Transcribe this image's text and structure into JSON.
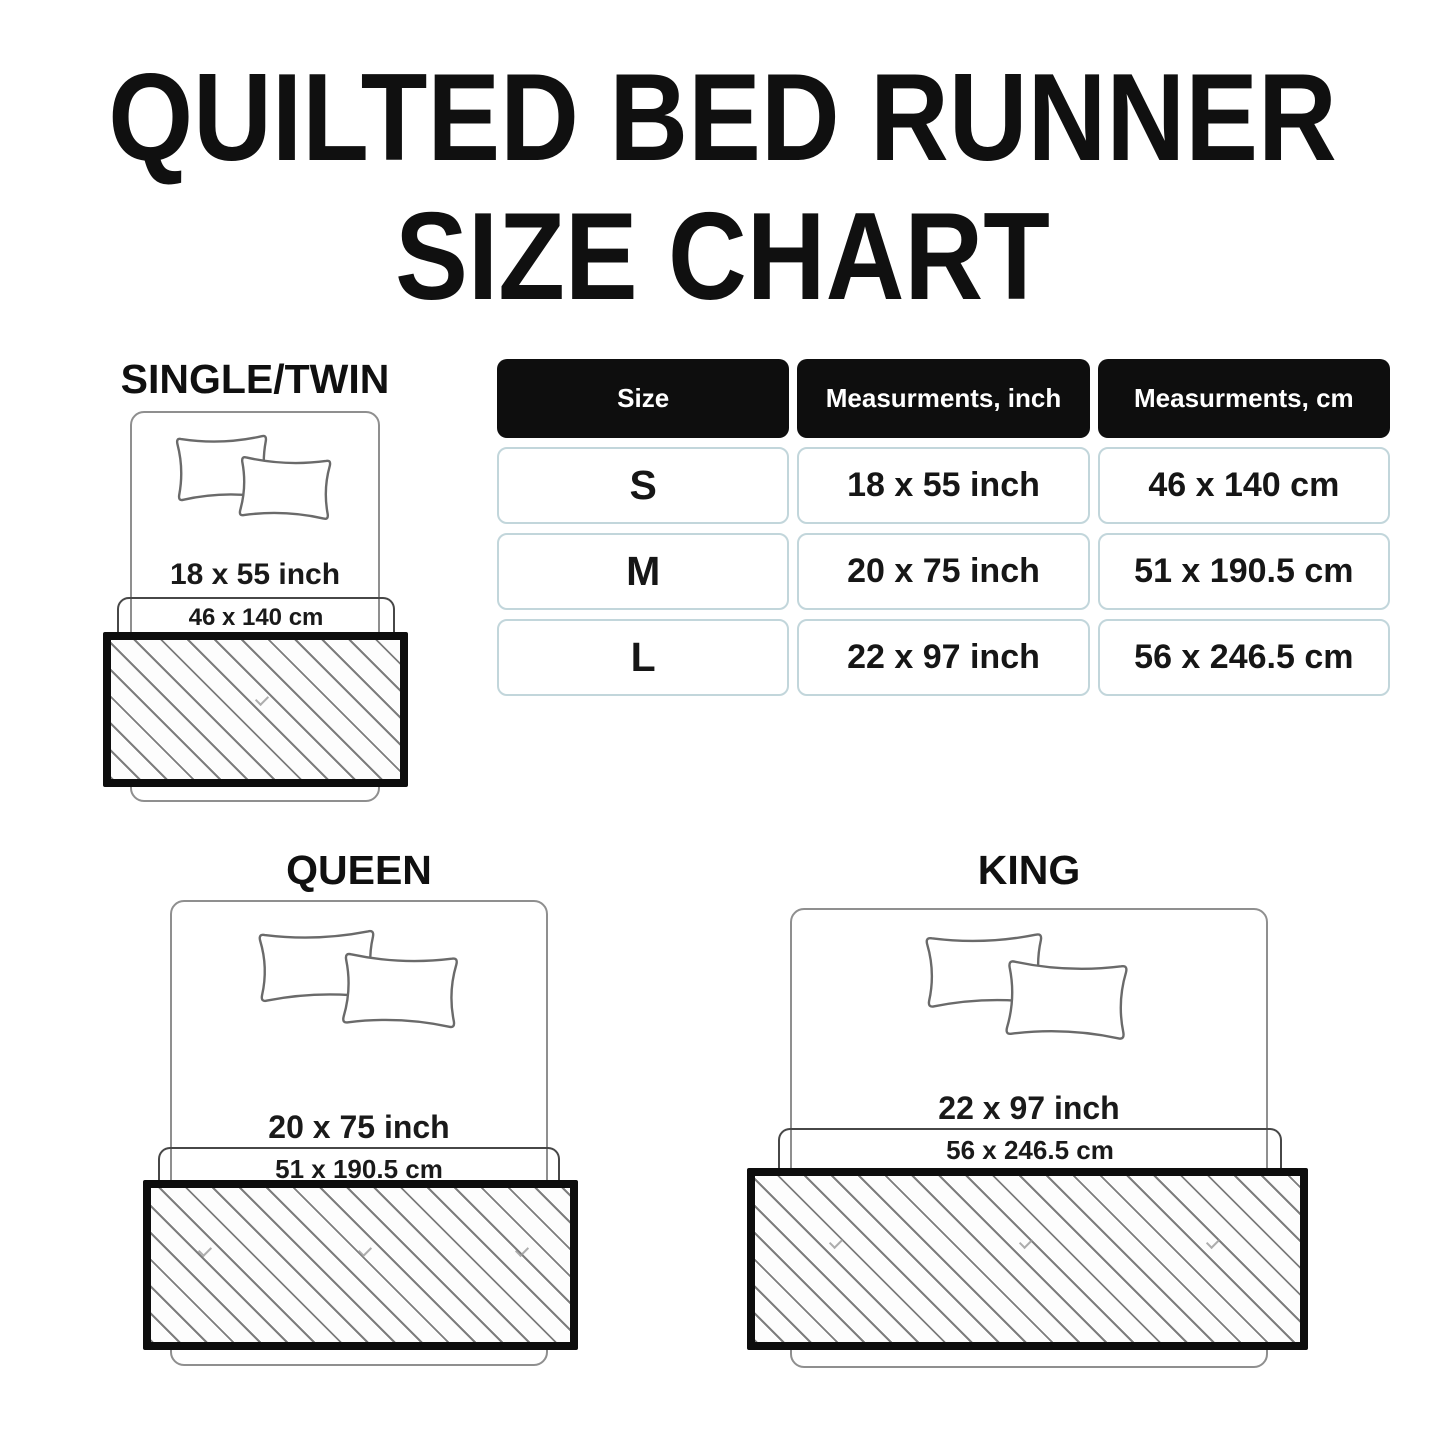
{
  "title": {
    "line1": "QUILTED BED RUNNER",
    "line2": "SIZE CHART"
  },
  "table": {
    "headers": [
      "Size",
      "Measurments, inch",
      "Measurments, cm"
    ],
    "rows": [
      {
        "size": "S",
        "inch": "18 x 55 inch",
        "cm": "46 x 140 cm"
      },
      {
        "size": "M",
        "inch": "20 x 75 inch",
        "cm": "51 x 190.5 cm"
      },
      {
        "size": "L",
        "inch": "22 x 97 inch",
        "cm": "56 x 246.5 cm"
      }
    ]
  },
  "diagrams": [
    {
      "label": "SINGLE/TWIN",
      "inch_label": "18 x 55 inch",
      "cm_label": "46 x 140 cm"
    },
    {
      "label": "QUEEN",
      "inch_label": "20 x 75 inch",
      "cm_label": "51 x 190.5 cm"
    },
    {
      "label": "KING",
      "inch_label": "22 x 97 inch",
      "cm_label": "56 x 246.5 cm"
    }
  ],
  "colors": {
    "ink": "#0d0d0d",
    "header_bg": "#0e0e0e",
    "header_text": "#ffffff",
    "table_cell_border": "#c2d6db",
    "bed_outline": "#8f8f8f",
    "cm_box_outline": "#474747",
    "hatch_line": "#7d7d7d"
  },
  "chart_data": {
    "type": "table",
    "title": "QUILTED BED RUNNER SIZE CHART",
    "columns": [
      "Size",
      "Measurments, inch",
      "Measurments, cm"
    ],
    "rows": [
      [
        "S",
        "18 x 55 inch",
        "46 x 140 cm"
      ],
      [
        "M",
        "20 x 75 inch",
        "51 x 190.5 cm"
      ],
      [
        "L",
        "22 x 97 inch",
        "56 x 246.5 cm"
      ]
    ]
  }
}
